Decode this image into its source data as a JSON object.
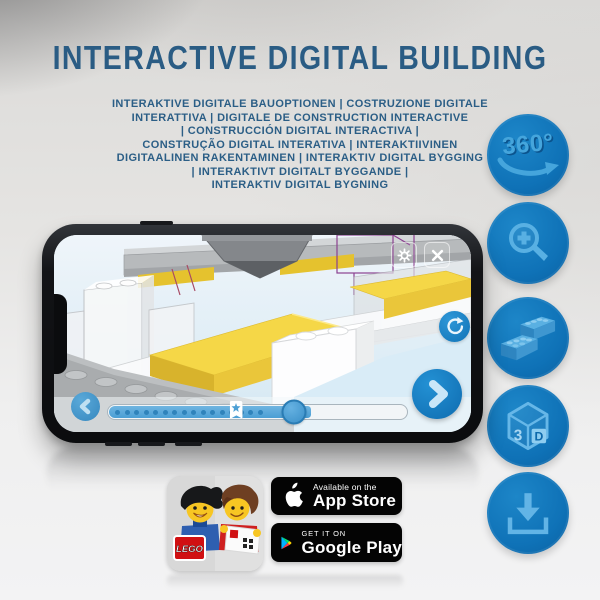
{
  "title": "INTERACTIVE DIGITAL BUILDING",
  "subtitle_lines": [
    "INTERAKTIVE DIGITALE BAUOPTIONEN | COSTRUZIONE DIGITALE",
    "INTERATTIVA | DIGITALE DE CONSTRUCTION INTERACTIVE",
    "| CONSTRUCCIÓN DIGITAL INTERACTIVA |",
    "CONSTRUÇÃO DIGITAL INTERATIVA | INTERAKTIIVINEN",
    "DIGITAALINEN RAKENTAMINEN | INTERAKTIV DIGITAL BYGGING",
    "| INTERAKTIVT DIGITALT BYGGANDE |",
    "INTERAKTIV DIGITAL BYGNING"
  ],
  "features": [
    {
      "icon": "360-rotation-icon",
      "label": "360°"
    },
    {
      "icon": "zoom-in-magnifier-icon",
      "label": ""
    },
    {
      "icon": "lego-bricks-icon",
      "label": ""
    },
    {
      "icon": "3d-cube-icon",
      "label_left": "3",
      "label_right": "D"
    },
    {
      "icon": "download-icon",
      "label": ""
    }
  ],
  "phone_ui": {
    "progress_percent": 65,
    "handle_percent": 62,
    "marker_percent": 43,
    "progress_dots": 16
  },
  "store_badges": {
    "app_store": {
      "tagline": "Available on the",
      "name": "App Store"
    },
    "google_play": {
      "tagline": "GET IT ON",
      "name": "Google Play"
    }
  },
  "app_icon": {
    "logo_text": "LEGO"
  },
  "colors": {
    "title_blue": "#2a5c84",
    "circle_blue": "#0f72b7",
    "icon_light_blue": "#54abdf",
    "lego_yellow": "#f0d042",
    "lego_red": "#d01012",
    "badge_black": "#040404"
  }
}
